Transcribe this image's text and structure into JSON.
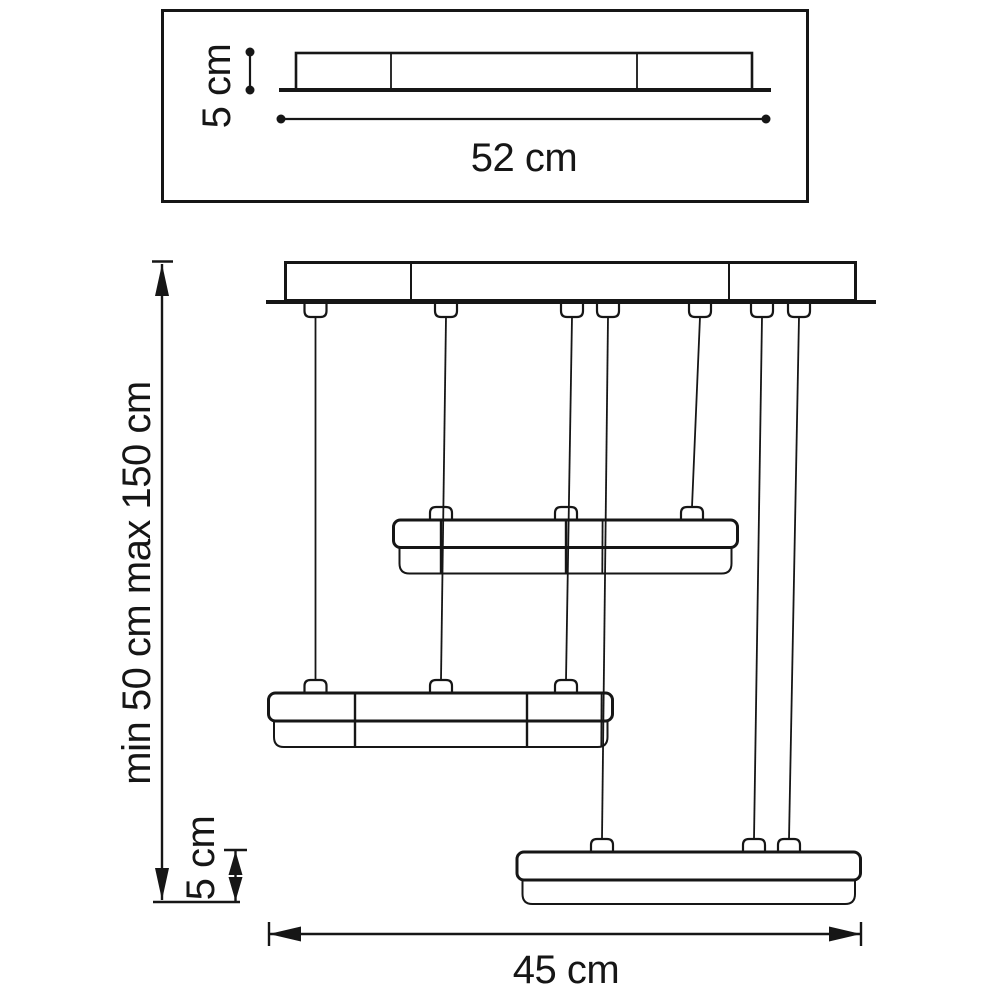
{
  "diagram": {
    "kind": "technical dimension drawing of a three-tier linear pendant chandelier",
    "colors": {
      "line": "#161616",
      "background": "#ffffff"
    },
    "detail_view": {
      "height_label": "5 cm",
      "width_label": "52 cm"
    },
    "main_view": {
      "suspension_wire_count": 7,
      "light_bar_count": 3,
      "drop_height_label": "min 50 cm max 150 cm",
      "bar_height_label": "5 cm",
      "width_label": "45 cm"
    }
  }
}
